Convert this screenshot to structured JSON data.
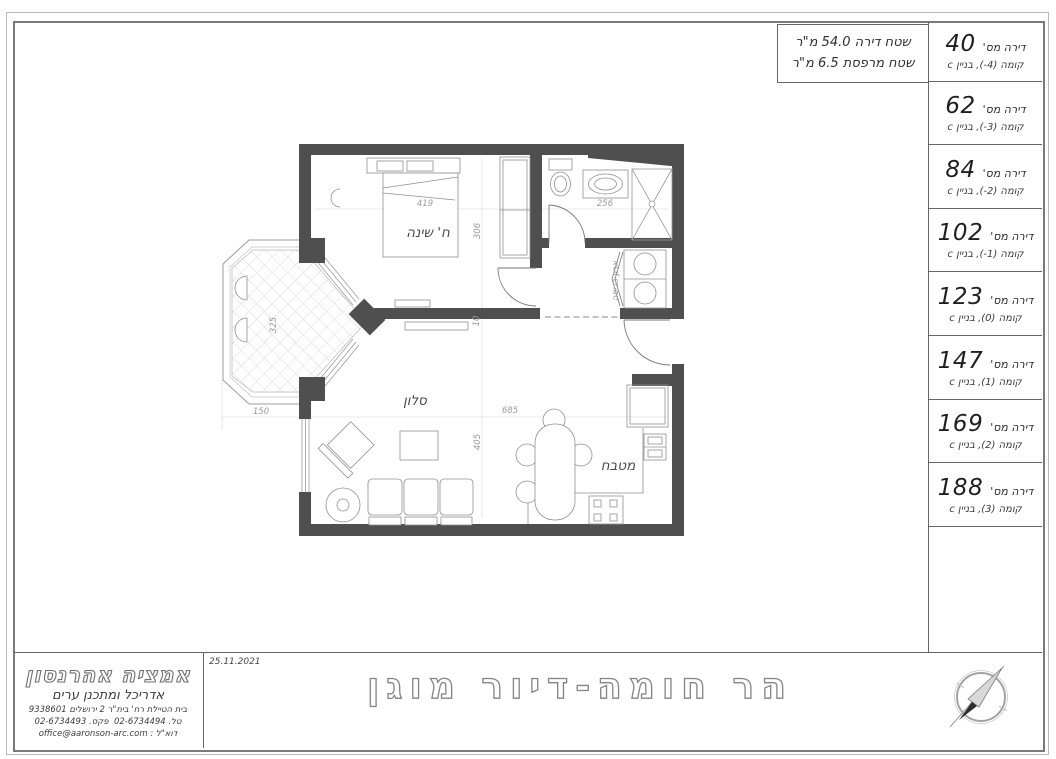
{
  "area_summary": {
    "apartment_area": "שטח דירה 54.0 מ\"ר",
    "balcony_area": "שטח מרפסת 6.5 מ\"ר"
  },
  "apartment_table": {
    "unit_label": "דירה מס'",
    "floor_label": "קומה",
    "rows": [
      {
        "number": "40",
        "floor_num": "(-4)",
        "building": ", בניין c"
      },
      {
        "number": "62",
        "floor_num": "(-3)",
        "building": ", בניין c"
      },
      {
        "number": "84",
        "floor_num": "(-2)",
        "building": ", בניין c"
      },
      {
        "number": "102",
        "floor_num": "(-1)",
        "building": ", בניין c"
      },
      {
        "number": "123",
        "floor_num": "(0)",
        "building": ", בניין c"
      },
      {
        "number": "147",
        "floor_num": "(1)",
        "building": ", בניין c"
      },
      {
        "number": "169",
        "floor_num": "(2)",
        "building": ", בניין c"
      },
      {
        "number": "188",
        "floor_num": "(3)",
        "building": ", בניין c"
      }
    ]
  },
  "plan": {
    "labels": {
      "bedroom": "ח' שינה",
      "living": "סלון",
      "kitchen": "מטבח",
      "laundry": "ארון כביסה"
    },
    "dims": {
      "bedroom_width": "419",
      "bedroom_depth": "306",
      "bath_width": "256",
      "balcony_depth": "325",
      "balcony_width": "150",
      "living_width": "685",
      "living_depth": "405",
      "wall": "10"
    }
  },
  "title_block": {
    "date": "25.11.2021",
    "project_title": "הר חומה-דיור מוגן",
    "architect": {
      "name": "אמציה אהרנסון",
      "profession": "אדריכל ומתכנן ערים",
      "address": "בית הטיילת רח' בית\"ר 2 ירושלים 9338601",
      "tel_label": "טל.",
      "tel": "02-6734494",
      "fax_label": "פקס.",
      "fax": "02-6734493",
      "email_label": "דוא\"ל :",
      "email": "office@aaronson-arc.com"
    }
  },
  "colors": {
    "wall": "#4f4f4f",
    "outline": "#8f8f8f",
    "dim": "#9a9a9a",
    "frame": "#777777"
  }
}
